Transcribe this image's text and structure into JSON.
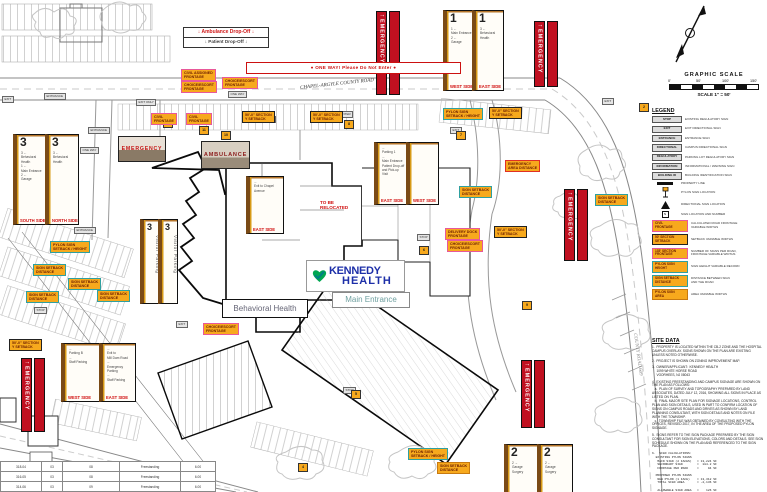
{
  "title": "Kennedy Health Campus Wayfinding Signage Site Plan",
  "colors": {
    "label_fill": "#F7A91D",
    "label_border_pink": "#E8589A",
    "label_border_teal": "#2FA0A0",
    "label_border_black": "#222222",
    "label_border_red": "#E03024",
    "emergency_red": "#C01020",
    "side_label_red": "#D00D0D",
    "logo_blue": "#1D2FA8",
    "logo_green": "#00A651"
  },
  "graphic_scale": {
    "title": "GRAPHIC SCALE",
    "ticks": [
      "0'",
      "50'",
      "100'",
      "150'"
    ],
    "caption": "SCALE 1\" = 50'"
  },
  "drop_off": {
    "line1": "↓  Ambulance Drop-Off  ↓",
    "line2": "↓  Patient Drop-Off  ↓"
  },
  "one_way": "●   ONE WAY!  Please Do Not Enter   ●",
  "road_labels": {
    "top": "CHAPEL-ARGYLE COUNTY ROAD",
    "right": "COUNTY ROAD 609"
  },
  "logo": {
    "word1": "KENNEDY",
    "word2": "HEALTH",
    "tag": "Main Entrance"
  },
  "notes": {
    "behavioral": "Behavioral Health",
    "relocate": "TO BE\nRELOCATED"
  },
  "photos": {
    "emergency": "EMERGENCY",
    "ambulance": "AMBULANCE"
  },
  "emergency_banner": "EMERGENCY",
  "panels": [
    {
      "num": "1",
      "entries": [
        "1 ←",
        "Main Entrance",
        "2 ←",
        "Garage"
      ],
      "side": "WEST SIDE"
    },
    {
      "num": "1",
      "entries": [
        "3 ←",
        "Behavioral",
        "Health"
      ],
      "side": "EAST SIDE"
    },
    {
      "num": "3",
      "entries": [
        "3 ←",
        "Behavioral Health",
        "1 ←",
        "Main Entrance",
        "2 ←",
        "Garage"
      ],
      "side": "SOUTH SIDE"
    },
    {
      "num": "3",
      "entries": [
        "3 ←",
        "Behavioral",
        "Health"
      ],
      "side": "NORTH SIDE"
    },
    {
      "num": "3",
      "entries": [
        "Visitor Parking"
      ],
      "side": ""
    },
    {
      "num": "3",
      "entries": [
        "Visitor Parking"
      ],
      "side": ""
    },
    {
      "num": "",
      "entries": [
        "←",
        "Parking 1",
        "←",
        "Main Entrance",
        "Patient Drop-off",
        "and Pick-up",
        "Visit"
      ],
      "side": "EAST SIDE"
    },
    {
      "num": "",
      "entries": [
        ""
      ],
      "side": "WEST SIDE"
    },
    {
      "num": "",
      "entries": [
        "←",
        "Exit to Chapel",
        "Avenue"
      ],
      "side": "EAST SIDE"
    },
    {
      "num": "",
      "entries": [
        "←",
        "Parking B",
        "←",
        "Staff Parking"
      ],
      "side": "WEST SIDE"
    },
    {
      "num": "",
      "entries": [
        "←",
        "Exit to",
        "Mill Dam Road",
        "←",
        "Emergency Parking",
        "←",
        "Staff Parking"
      ],
      "side": "EAST SIDE"
    },
    {
      "num": "2",
      "entries": [
        "2 →",
        "Garage",
        "Surgery"
      ],
      "side": ""
    },
    {
      "num": "2",
      "entries": [
        "2 ←",
        "Garage",
        "Surgery"
      ],
      "side": ""
    }
  ],
  "map_labels": [
    {
      "t": "CIVIL ASSIGNED\nFRONTAGE"
    },
    {
      "t": "CHOICE/ESCORT\nFRONTAGE"
    },
    {
      "t": "CHOICE/ESCORT\nFRONTAGE"
    },
    {
      "t": "CIVIL\nFRONTAGE"
    },
    {
      "t": "CIVIL\nFRONTAGE"
    },
    {
      "t": "50'-0\" SECTION\nY SETBACK"
    },
    {
      "t": "50'-0\" SECTION\nY SETBACK"
    },
    {
      "t": "PYLON SIGN\nSETBACK / HEIGHT"
    },
    {
      "t": "50'-0\" SECTION\nY SETBACK"
    },
    {
      "t": "EMERGENCY\nAREA DISTANCE"
    },
    {
      "t": "SIGN SETBACK\nDISTANCE"
    },
    {
      "t": "DELIVERY DOCK\nFRONTAGE"
    },
    {
      "t": "CHOICE/ESCORT\nFRONTAGE"
    },
    {
      "t": "50'-0\" SECTION\nY SETBACK"
    },
    {
      "t": "SIGN SETBACK\nDISTANCE"
    },
    {
      "t": "PYLON SIGN\nSETBACK / HEIGHT"
    },
    {
      "t": "SIGN SETBACK\nDISTANCE"
    },
    {
      "t": "SIGN SETBACK\nDISTANCE"
    },
    {
      "t": "SIGN SETBACK\nDISTANCE"
    },
    {
      "t": "SIGN SETBACK\nDISTANCE"
    },
    {
      "t": "50'-0\" SECTION\nY SETBACK"
    },
    {
      "t": "CHOICE/ESCORT\nFRONTAGE"
    },
    {
      "t": "PYLON SIGN\nSETBACK / HEIGHT"
    },
    {
      "t": "SIGN SETBACK\nDISTANCE"
    }
  ],
  "micro": [
    {
      "t": "EXIT"
    },
    {
      "t": "ENTRANCE"
    },
    {
      "t": "EXIT ONLY"
    },
    {
      "t": "ENTRANCE"
    },
    {
      "t": "ONE WAY"
    },
    {
      "t": "ENTRANCE"
    },
    {
      "t": "STOP"
    },
    {
      "t": "EXIT"
    },
    {
      "t": "ONE WAY"
    },
    {
      "t": "ENTER"
    },
    {
      "t": "STOP"
    },
    {
      "t": "EXIT"
    },
    {
      "t": "STOP"
    },
    {
      "t": "EXIT"
    },
    {
      "t": "ONE WAY"
    }
  ],
  "markers": [
    {
      "t": "12"
    },
    {
      "t": "11"
    },
    {
      "t": "10"
    },
    {
      "t": "8"
    },
    {
      "t": "6"
    },
    {
      "t": "7"
    },
    {
      "t": "4"
    },
    {
      "t": "5"
    },
    {
      "t": "9"
    },
    {
      "t": "2"
    }
  ],
  "legend": {
    "heading": "LEGEND",
    "sign_types": [
      {
        "box": "STOP",
        "desc": "EXISTING REGULATORY SIGN"
      },
      {
        "box": "EXIT",
        "desc": "EXIT DIRECTIONAL SIGN"
      },
      {
        "box": "ENTRANCE",
        "desc": "ENTRANCE SIGN"
      },
      {
        "box": "DIRECTIONAL",
        "desc": "CAMPUS DIRECTIONAL SIGN"
      },
      {
        "box": "REGULATORY",
        "desc": "PARKING LOT REGULATORY SIGN"
      },
      {
        "box": "INFORMATION",
        "desc": "INFORMATIONAL / WARNING SIGN"
      },
      {
        "box": "BUILDING ID",
        "desc": "BUILDING IDENTIFICATION SIGN"
      }
    ],
    "symbols": [
      {
        "desc": "PROPERTY LINE"
      },
      {
        "desc": "PYLON SIGN LOCATION"
      },
      {
        "desc": "DIRECTIONAL SIGN LOCATION"
      },
      {
        "desc": "SIGN LOCATION AND NUMBER"
      }
    ],
    "measures": [
      {
        "box": "CIVIL\nFRONTAGE",
        "desc": "CALCULATED ROAD FRONTAGE\nVARIABLE WIDTHS"
      },
      {
        "box": "50' SECTION\nSETBACK",
        "desc": "SETBACK VARIABLE WIDTHS"
      },
      {
        "box": "135' SECTION\nFRONTAGE",
        "desc": "NUMBER OF SIGNS PER ROAD,\nFRONTAGE VARIABLE WIDTHS"
      },
      {
        "box": "PYLON SIGN\nHEIGHT",
        "desc": "SIGN HEIGHT VARIABLE RECORD"
      },
      {
        "box": "SIGN SETBACK\nDISTANCE",
        "desc": "DISTANCE BETWEEN SIGN\nAND THE ROAD"
      },
      {
        "box": "PYLON SIGN\nAREA",
        "desc": "AREA VARIABLE WIDTHS"
      }
    ]
  },
  "site_data": {
    "heading": "SITE DATA",
    "items": [
      "1.  PROPERTY IS LOCATED WITHIN THE CB-2 ZONE AND THE HOSPITAL CAMPUS OVERLAY. SIGNS SHOWN ON THE PLAN ARE EXISTING UNLESS NOTED OTHERWISE.",
      "2.  PROJECT IS SHOWN ON ZONING IMPROVEMENT MAP.",
      "3.  OWNER/APPLICANT:  KENNEDY HEALTH\n     1099 WHITE HORSE ROAD\n     VOORHEES, NJ 08043",
      "4.  EXISTING FREESTANDING AND CAMPUS SIGNAGE ARE SHOWN ON THE PLAN AS FOLLOWS:\n   a.  PLAN OF SURVEY AND TOPOGRAPHY PREPARED BY LAND ASSOCIATES, DATED JULY 12, 2016, SHOWING ALL SIGNS IN PLACE AS LISTED ON PLAN.\n   b.  FINAL MAJOR SITE PLAN FOR SIGNAGE LOCATIONS, CONTROL PLAN AND SIGN DETAILS, USED IN PART TO CONFIRM LOCATION OF SIGNS ON CAMPUS ROADS AND DRIVES AS SHOWN BY LAND PLANNING CONSULTANT, WITH SIGN DETAILS AND NOTES ON FILE WITH THE TOWNSHIP.\n   c.  TOWNSHIP FILE WAS OBTAINED BY CONSULTING WITH THE OFFICES, REVISED 2017, IN THE AREA OF THE PROPOSED PYLON SIGNAGE.",
      "5.  SIGNS REFER TO THE SIGN PACKAGE PREPARED BY THE SIGN CONSULTANT FOR SIGN ELEVATIONS, COLORS AND DETAILS. SEE SIGN SCHEDULE SHOWN ON THE PLAN AND REFERENCED TO THE SIGN PACKAGE.",
      "6.  SIGN CALCULATIONS:\n  EXISTING PYLON SIGNS\n   MAIN SIGN (2 FACES)   = 13,224 SF\n   SECONDARY SIGN        =  184.2 SF\n   FRONTAGE PER ROAD     =     94 SF",
      "  PROPOSED PYLON SIGNS\n   NEW PYLON (1 FACE)    = 13,312 SF\n   TOTAL SIGN AREA       = -2,136 SF\n\n   ALLOWABLE SIGN AREA   =    126 SF"
    ]
  },
  "schedule": {
    "rows": [
      [
        "318-04",
        "03",
        "08",
        "Freestanding",
        "6.00"
      ],
      [
        "316-05",
        "03",
        "08",
        "Freestanding",
        "6.00"
      ],
      [
        "314-06",
        "03",
        "09",
        "Freestanding",
        "6.00"
      ]
    ]
  }
}
